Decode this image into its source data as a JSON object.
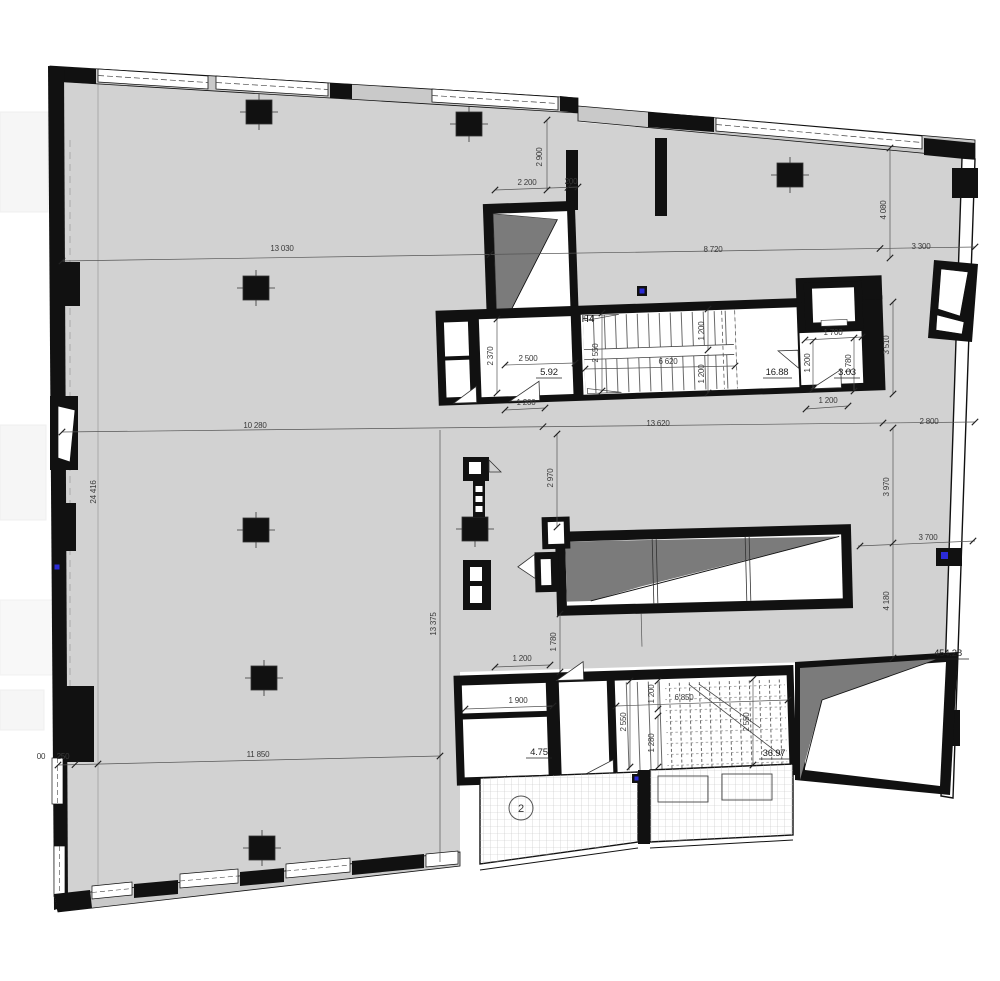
{
  "document": {
    "type": "architectural-floor-plan",
    "stair_room_label": "Н4",
    "terrace_zone_number": "2",
    "areas_m2": {
      "main_hall": "454.28",
      "upper_stair": "16.88",
      "upper_vestibule": "5.92",
      "upper_elevator_lobby": "3.03",
      "lower_vestibule": "4.75",
      "lower_stair": "36.97"
    }
  },
  "colors": {
    "floor_fill": "#d2d2d2",
    "wall_black": "#111111",
    "wall_band_fill": "#c9c9c9",
    "ramp_wedge_gray": "#7b7b7b",
    "hatch_line": "#c2c2c2",
    "dimension_text": "#3a3a3a",
    "symbol_blue": "#2b2bd6",
    "outside_white": "#ffffff"
  },
  "labels": [
    {
      "name": "dim-2900",
      "t": "2 900"
    },
    {
      "name": "dim-2200",
      "t": "2 200"
    },
    {
      "name": "dim-200",
      "t": "200"
    },
    {
      "name": "dim-13030",
      "t": "13 030"
    },
    {
      "name": "dim-8720",
      "t": "8 720"
    },
    {
      "name": "dim-3300",
      "t": "3 300"
    },
    {
      "name": "dim-4080",
      "t": "4 080"
    },
    {
      "name": "room-label-h4",
      "t": "Н4"
    },
    {
      "name": "dim-2370",
      "t": "2 370"
    },
    {
      "name": "dim-2500",
      "t": "2 500"
    },
    {
      "name": "area-5-92",
      "t": "5.92"
    },
    {
      "name": "dim-2550-upper",
      "t": "2 550"
    },
    {
      "name": "dim-6620",
      "t": "6 620"
    },
    {
      "name": "dim-1200-flight-a",
      "t": "1 200"
    },
    {
      "name": "dim-1200-flight-b",
      "t": "1 200"
    },
    {
      "name": "area-16-88",
      "t": "16.88"
    },
    {
      "name": "dim-1700",
      "t": "1 700"
    },
    {
      "name": "dim-1200-elev",
      "t": "1 200"
    },
    {
      "name": "dim-1780-elev",
      "t": "1 780"
    },
    {
      "name": "area-3-03",
      "t": "3.03"
    },
    {
      "name": "dim-1200-door-left",
      "t": "1 200"
    },
    {
      "name": "dim-1200-door-right",
      "t": "1 200"
    },
    {
      "name": "dim-10280",
      "t": "10 280"
    },
    {
      "name": "dim-13620",
      "t": "13 620"
    },
    {
      "name": "dim-2800",
      "t": "2 800"
    },
    {
      "name": "dim-2970",
      "t": "2 970"
    },
    {
      "name": "dim-3970",
      "t": "3 970"
    },
    {
      "name": "dim-24416",
      "t": "24 416"
    },
    {
      "name": "dim-3700",
      "t": "3 700"
    },
    {
      "name": "dim-4180",
      "t": "4 180"
    },
    {
      "name": "dim-13375",
      "t": "13 375"
    },
    {
      "name": "dim-1780-mid",
      "t": "1 780"
    },
    {
      "name": "area-454-28",
      "t": "454.28"
    },
    {
      "name": "dim-1200-lower-door",
      "t": "1 200"
    },
    {
      "name": "dim-1900",
      "t": "1 900"
    },
    {
      "name": "area-4-75",
      "t": "4.75"
    },
    {
      "name": "dim-2550-lower-left",
      "t": "2 550"
    },
    {
      "name": "dim-1200-lower-flight",
      "t": "1 200"
    },
    {
      "name": "dim-1280-lower-flight",
      "t": "1 280"
    },
    {
      "name": "dim-6850",
      "t": "6 850"
    },
    {
      "name": "dim-2550-lower-right",
      "t": "2 550"
    },
    {
      "name": "area-36-97",
      "t": "36.97"
    },
    {
      "name": "dim-00",
      "t": "00"
    },
    {
      "name": "dim-250",
      "t": "250"
    },
    {
      "name": "dim-11850",
      "t": "11 850"
    },
    {
      "name": "dim-3510",
      "t": "3 510"
    },
    {
      "name": "terrace-number",
      "t": "2"
    }
  ]
}
